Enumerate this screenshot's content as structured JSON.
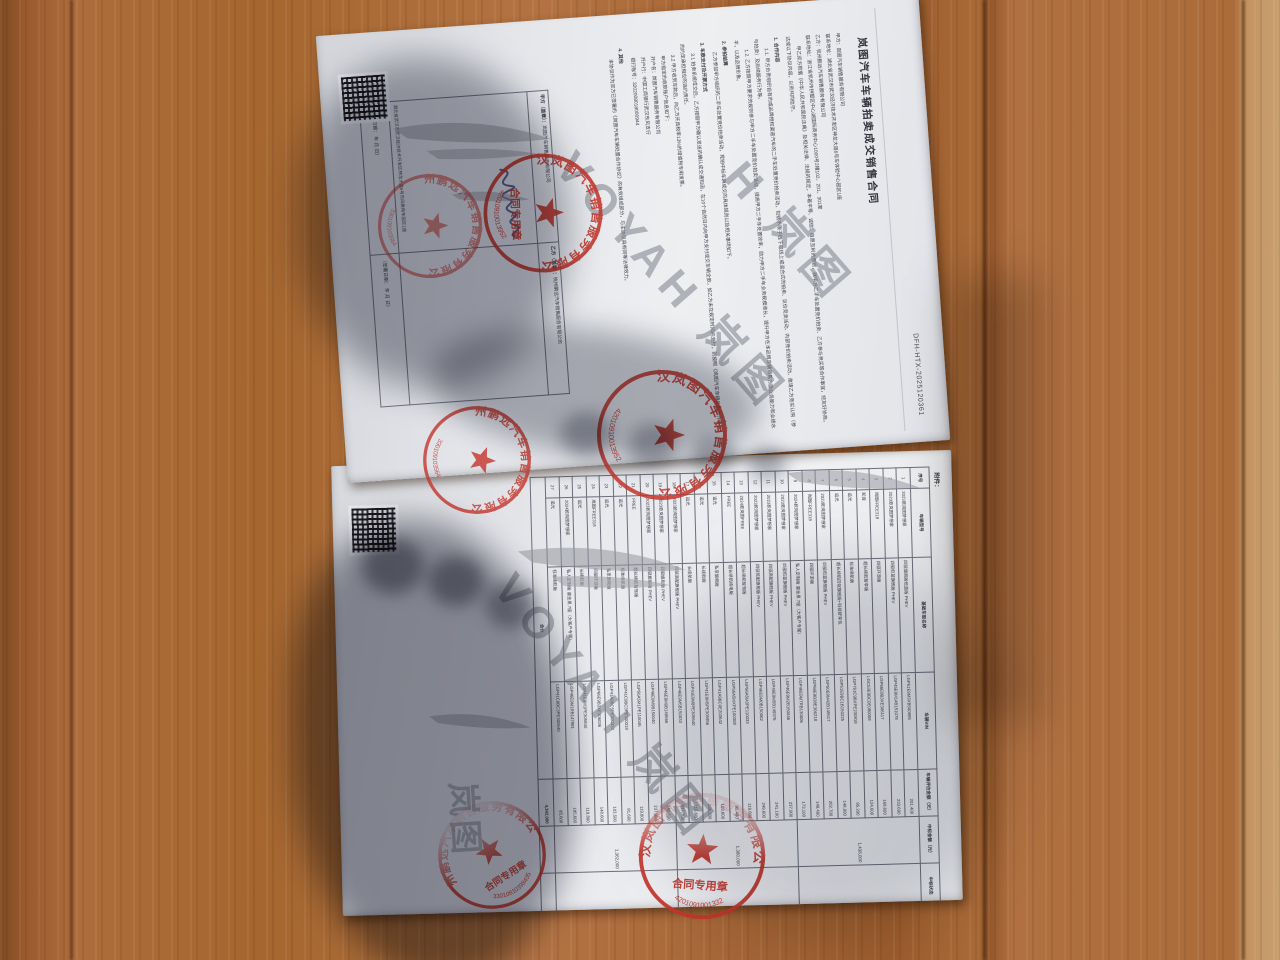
{
  "document": {
    "page1": {
      "title": "岚图汽车车辆拍卖成交销售合同",
      "contract_no": "DFH-HTX-2025120361",
      "lines": [
        {
          "k": "kv",
          "t": "甲方：岚图汽车销售服务有限公司"
        },
        {
          "k": "kv",
          "t": "联系地址：湖北省武汉市武汉经济技术开发区神龙大道6号车体验中心园区1座"
        },
        {
          "k": "kv",
          "t": "乙方：杭州鹏远汽车销售服务有限公司"
        },
        {
          "k": "kv",
          "t": "联系地址：浙江省杭州市拱墅区中心湖国际商务中心1000号2幢102、201、301室"
        },
        {
          "k": "para",
          "t": "甲乙双方根据《中华人民共和国民法典》及相关法律、法规的规定，本着平等、诚信、自愿互利的原则，就甲方二手车处置竞价拍卖、乙方参与竞买等合作事宜，经友好协商，达成以下协议内容，以资共同信守。"
        },
        {
          "k": "h",
          "t": "1. 合作内容"
        },
        {
          "k": "para",
          "t": "1.1. 甲方负责组织自有的或品牌授权渠道汽车的二手车处置竞价拍卖活动，包括不限于线下或线上或混合式的拍卖、议价竞卖活动、内部竞价拍卖活动，邀请乙方竞买认购（参与拍卖）及后续服务行为等。"
        },
        {
          "k": "para",
          "t": "1.2. 乙方按照甲方要求的规则参与甲方二手车处置竞价拍卖活动，提高甲方二手车处置效率，助力甲方二手车业务规模增长，提升甲方在本品牌车辆销售方面业务能力和业绩水平，以及品牌形象。"
        },
        {
          "k": "h",
          "t": "2. 参拍结算"
        },
        {
          "k": "para",
          "t": "乙方参加甲方组织的二手车处置竞价拍卖活动，竞拍中标车辆成交的具体规则以及相关事项如下。"
        },
        {
          "k": "h",
          "t": "3. 车款支付及开票方式"
        },
        {
          "k": "para",
          "t": "3.1 拍卖系统成交后，乙方按照甲方确认发送的确认成交通知函，在10个自然日内向甲方支付成交车辆全款，如乙方未在规定时间内支付，则按照《岚图汽车车辆处置合作协议》的约定承担相应的违约责任。"
        },
        {
          "k": "para",
          "t": "3.2 甲方收到车款后，向乙方开具税率13%的增值税专用发票。"
        },
        {
          "k": "ind",
          "t": "甲方指定的收款账户信息如下："
        },
        {
          "k": "ind",
          "t": "开户名：岚图汽车销售服务有限公司"
        },
        {
          "k": "ind",
          "t": "开户行：中国工商银行武汉东风支行"
        },
        {
          "k": "ind",
          "t": "银行账号：3202008018000944"
        },
        {
          "k": "h",
          "t": "4. 其他"
        },
        {
          "k": "para",
          "t": "本协议作为双方已签署的《岚图汽车车辆处置合作协议》的有效组成部分，与主协议具有同等法律效力。"
        }
      ],
      "sign_table": {
        "parties": [
          {
            "party": "甲方（盖章）：",
            "company": "岚图汽车销售服务有限公司",
            "address": "湖北省武汉市武汉经济技术开发区神龙大道6号东风乘用车园区1座",
            "date": "（签署日期：    年    月    日）"
          },
          {
            "party": "乙方（盖章）：",
            "company": "杭州鹏远汽车销售服务有限公司",
            "address": "",
            "date": "（签署日期：    年    月    日）"
          }
        ]
      }
    },
    "page2": {
      "attachment_label": "附件：",
      "vehicle_table": {
        "columns": [
          "序号",
          "车辆型号",
          "基础车型名称",
          "车辆VIN",
          "车辆评估金额（元）",
          "中标金额（元）",
          "中标状态"
        ],
        "rows": [
          [
            "1",
            "2023款岚图梦想家",
            "四驱旗舰版低蓝版 PHEV",
            "LGP51E9M3XB500985",
            "201,400"
          ],
          [
            "2",
            "2023款岚图梦想家",
            "四驱低蓝旗舰版 PHEV",
            "LGP45E9M14B151078",
            "233,600"
          ],
          [
            "3",
            "岚图FREE318",
            "四驱环游版",
            "LGP66E9B3XE306117",
            "168,600"
          ],
          [
            "4",
            "知音",
            "超长续航智享版",
            "LGC53E9BC0E080058",
            "124,600"
          ],
          [
            "5",
            "追光",
            "标准续航版",
            "LGP761C9BXPE230918",
            "95,200"
          ],
          [
            "6",
            "追光",
            "超长续航四驱旗舰版+科技舒享包",
            "LGP51E9BC1B150225",
            "148,000"
          ],
          [
            "7",
            "2023款岚图梦想家",
            "四驱低蓝旗舰版 PHEV",
            "LGP50E9M42B145517",
            "202,700"
          ],
          [
            "8",
            "岚图FREE318",
            "四驱环游版",
            "LGP66E9B38E306218",
            "149,400"
          ],
          [
            "9",
            "2024款岚图梦想家",
            "私人定制版 鎏金黑 7座（大客户专属）",
            "LGP46E9M7RB130006",
            "173,100"
          ],
          [
            "10",
            "2023款岚图梦想家",
            "四驱低蓝旗舰版 PHEV",
            "LGP46E9M2B150046",
            "237,900"
          ],
          [
            "11",
            "2023款岚图梦想家",
            "四驱高配旗舰版 PHEV",
            "LGP46E9M5B149376",
            "241,100"
          ],
          [
            "12",
            "2023款岚图梦想家",
            "四驱低配旗舰版 PHEV",
            "LGP46E9M0B150062",
            "249,600"
          ],
          [
            "13",
            "2024款岚图FREE",
            "超长续航智驾版",
            "LGP56A5M3PE110033",
            "119,800"
          ],
          [
            "14",
            "FREE",
            "超长续航纯电版",
            "LGP56A5MXPE100308",
            "95,400"
          ],
          [
            "15",
            "追光",
            "私享旗舰版",
            "LGP41A9BC0E203642",
            "103,600"
          ],
          [
            "16",
            "追光",
            "长续航版",
            "LGP41E9M5PE305956",
            "136,200"
          ],
          [
            "17",
            "追光",
            "长续航版",
            "LGP41E9M8PE305640",
            "115,600"
          ],
          [
            "18",
            "2023款岚图梦想家",
            "四驱高配旗舰版 PHEV",
            "LGP46E9M5B150033",
            "247,700"
          ],
          [
            "19",
            "2023款岚图梦想家",
            "四驱旗舰版 PHEV",
            "LGP46E9M0B149566",
            "246,600"
          ],
          [
            "20",
            "2023款岚图梦想家",
            "四驱旗舰版 PHEV",
            "LGP46E9M9B150040",
            "237,900"
          ],
          [
            "21",
            "FREE",
            "超长续航智驾版",
            "LGP56A5M1PE110046",
            "119,800"
          ],
          [
            "22",
            "追光",
            "标准续航版",
            "LGP41C9BC3PE300318",
            "81,600"
          ],
          [
            "23",
            "追光",
            "私享旗舰版",
            "LGP41A9BC5PE300333",
            "103,500"
          ],
          [
            "24",
            "岚图FREE318",
            "四驱环游版",
            "LGP66E9B3XE306036",
            "148,600"
          ],
          [
            "25",
            "追光",
            "长续航版",
            "LGP41E9M1PE305840",
            "119,800"
          ],
          [
            "26",
            "2024款岚图梦想家",
            "私人定制版 鎏金黑 7座（大客户专属）",
            "LGP46E9M1RB147981",
            "185,600"
          ],
          [
            "27",
            "追光",
            "标准续航版",
            "LGP41C9BC3PE300540",
            "95,600"
          ]
        ],
        "bid_groups": [
          {
            "from": 1,
            "to": 9,
            "amount": "1,438,000",
            "status": ""
          },
          {
            "from": 10,
            "to": 18,
            "amount": "1,380,000",
            "status": "19"
          },
          {
            "from": 19,
            "to": 27,
            "amount": "1,362,000",
            "status": "20"
          }
        ],
        "total": {
          "label": "合计",
          "amount": "4,342,000"
        }
      }
    },
    "stamps": [
      {
        "id": "jiafang-contract-seal",
        "ring": "武汉岚图汽车销售服务有限公司",
        "center": "合同专用章",
        "number": "42010910013952"
      },
      {
        "id": "yifang-company-seal",
        "ring": "杭州鹏远汽车销售服务有限公司",
        "center": "",
        "number": "330109103564"
      },
      {
        "id": "cross-page-seal-yifang",
        "ring": "杭州鹏远汽车销售服务有限公司",
        "center": "",
        "number": "330109103564"
      },
      {
        "id": "cross-page-seal-jiafang",
        "ring": "武汉岚图汽车销售服务有限公司",
        "center": "",
        "number": "42010910013952"
      },
      {
        "id": "page2-seal-yifang",
        "ring": "杭州鹏远汽车销售服务有限公司",
        "center": "合同专用章",
        "number": "33010810398435"
      },
      {
        "id": "page2-seal-jiafang",
        "ring": "武汉岚图汽车销售服务有限公司",
        "center": "合同专用章",
        "number": "4201091001332"
      }
    ],
    "watermark": {
      "text": "VOYAH 岚图",
      "partial1": "H 岚图",
      "partial2": "岚图"
    },
    "colors": {
      "seal_red": "#c5352c",
      "paper": "#e9eaee",
      "wood": "#a5662f",
      "text": "#3f4049"
    }
  }
}
